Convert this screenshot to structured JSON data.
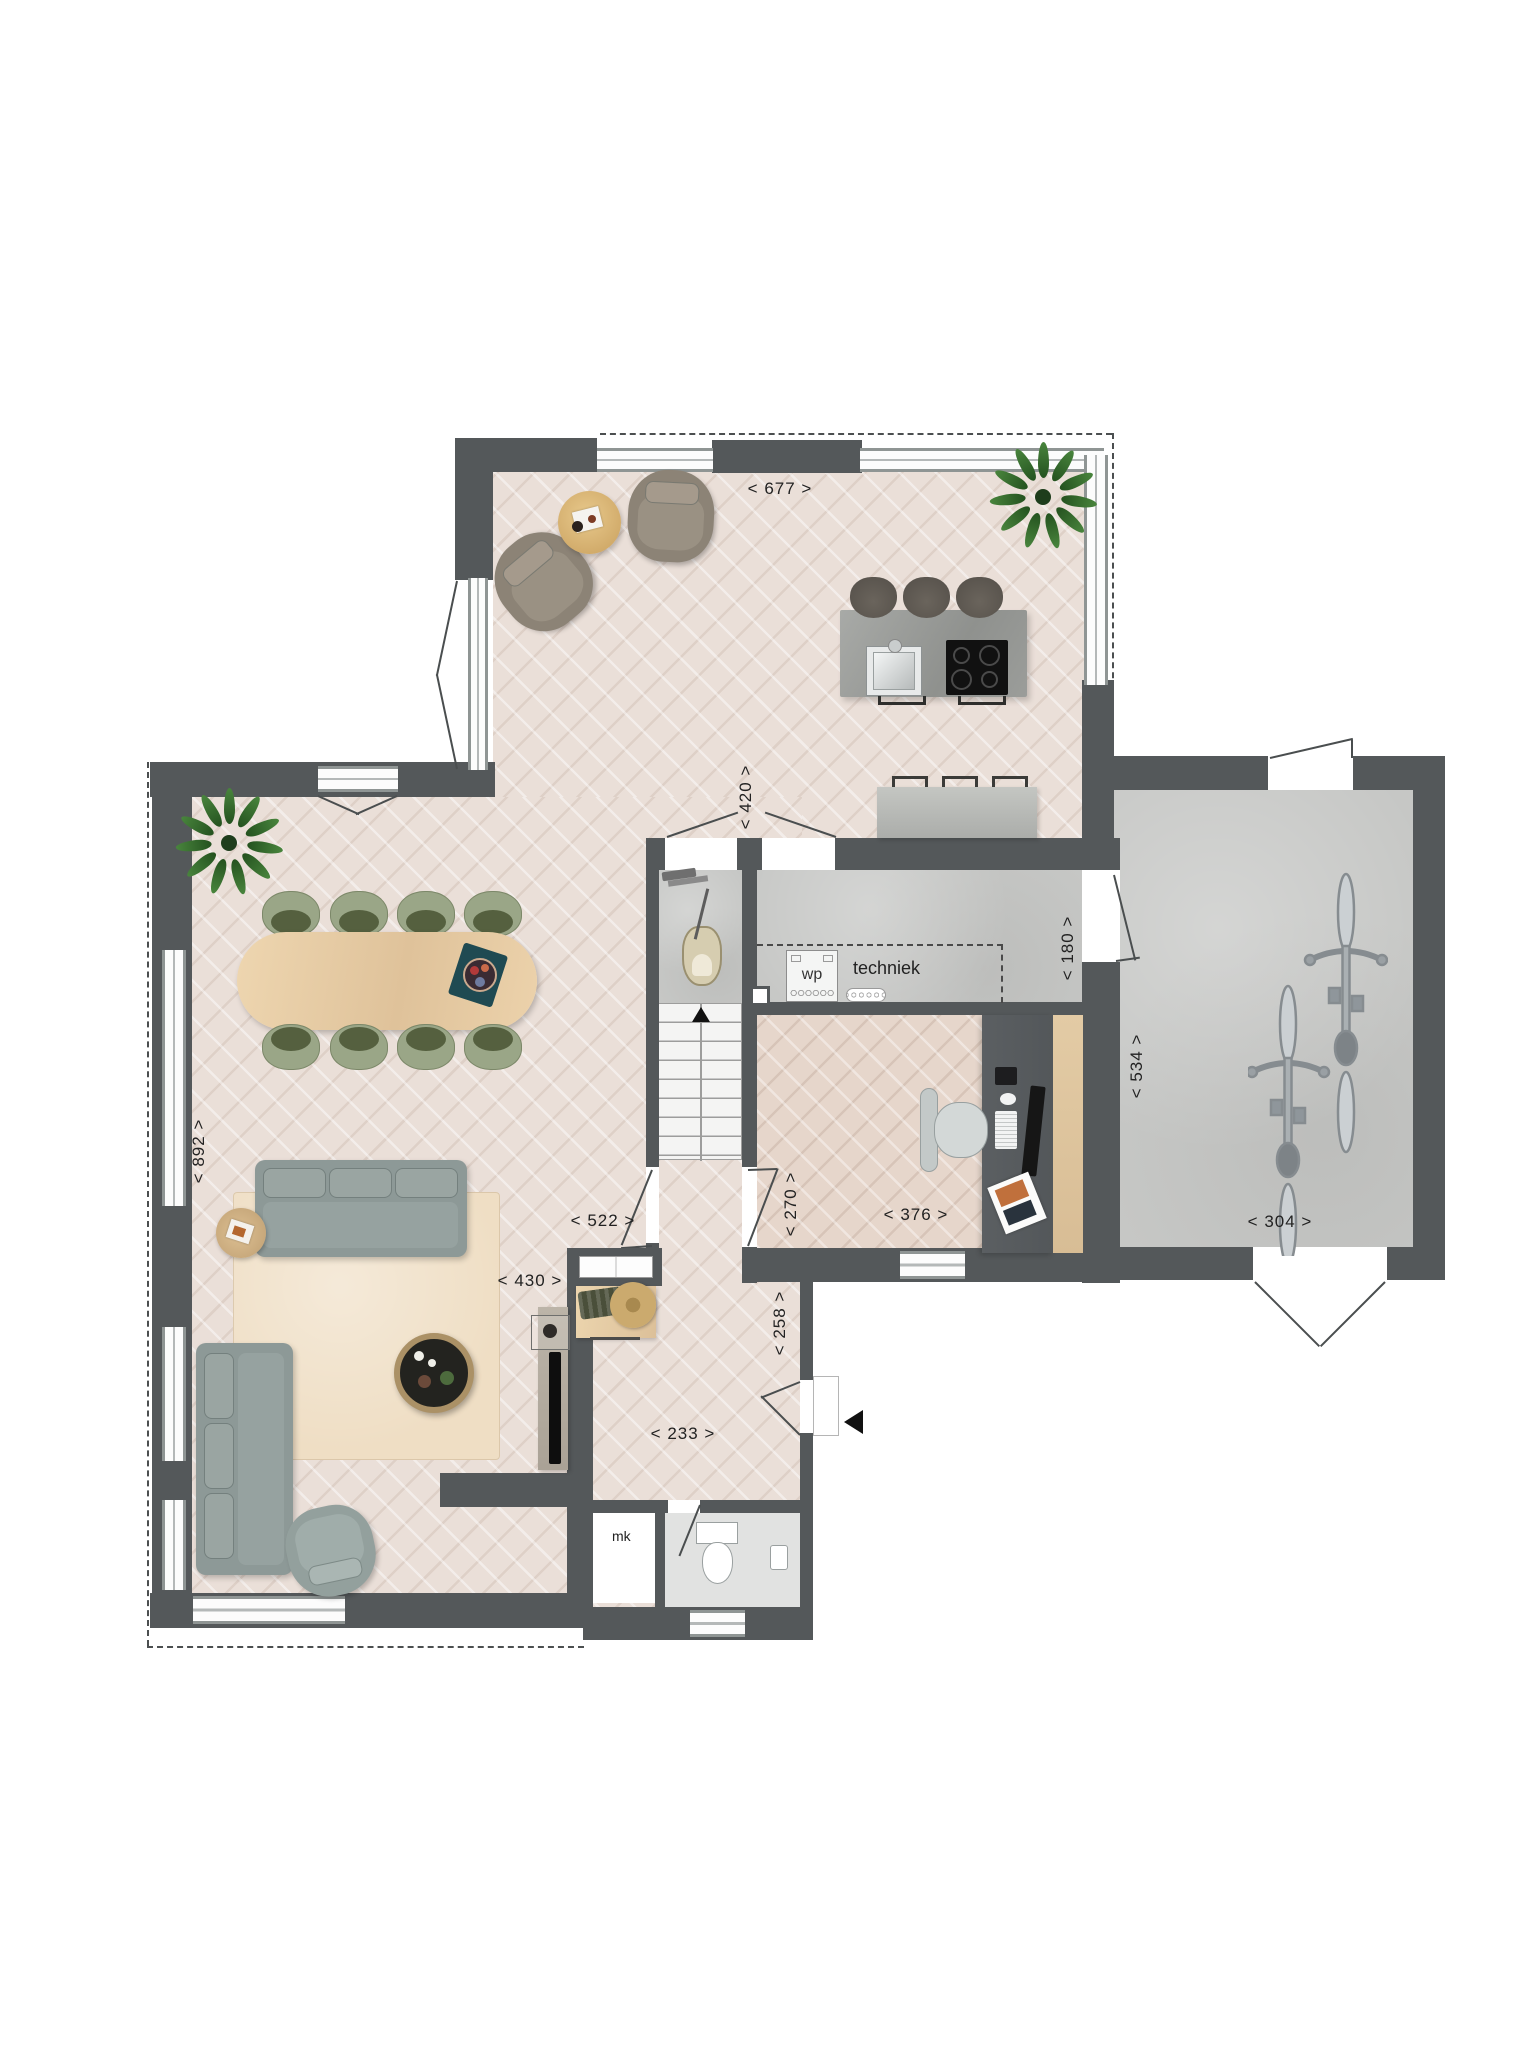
{
  "plan": {
    "type": "floorplan-ground-floor",
    "dimension_labels": {
      "sitting_width": "< 677 >",
      "kitchen_passage": "< 420 >",
      "living_depth": "< 892 >",
      "techniek_width": "< 180 >",
      "garage_depth": "< 534 >",
      "hall_width": "< 522 >",
      "living_opening": "< 430 >",
      "hall_passage": "< 270 >",
      "study_width": "< 376 >",
      "garage_width": "< 304 >",
      "entry_width": "< 233 >",
      "entry_depth": "< 258 >"
    },
    "room_labels": {
      "techniek": "techniek",
      "heat_pump": "wp",
      "meter_cupboard": "mk"
    },
    "icons": {
      "entrance_arrow": "left-filled-triangle",
      "stairs_direction_arrow": "up-filled-triangle"
    },
    "colors": {
      "wall": "#54585a",
      "wood_floor": "#eadfd8",
      "concrete_floor": "#c6c7c5",
      "chair_green": "#9aa687",
      "sofa_gray": "#8d9997",
      "rug_beige": "#efdec4",
      "table_oak": "#e8cfa9",
      "island_concrete": "#9ea09d"
    }
  }
}
